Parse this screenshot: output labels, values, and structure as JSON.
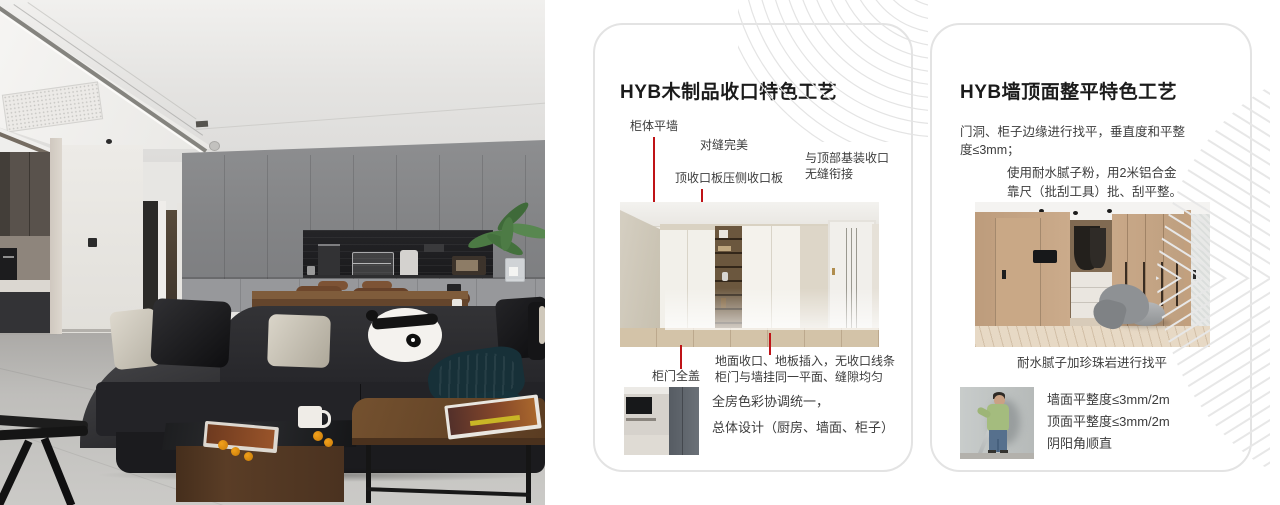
{
  "colors": {
    "accent_red": "#bf1317",
    "card_border": "#e3e3e3",
    "title_text": "#1b1b1b",
    "body_text": "#3c3c3c"
  },
  "cards": [
    {
      "title": "HYB木制品收口特色工艺",
      "callout_cabinet_wall": "柜体平墙",
      "callout_seam": "对缝完美",
      "callout_top_panel": "顶收口板压侧收口板",
      "callout_top_joint_1": "与顶部基装收口",
      "callout_top_joint_2": "无缝衔接",
      "callout_door_cover": "柜门全盖",
      "note_floor_1": "地面收口、地板插入，无收口线条",
      "note_floor_2": "柜门与墙挂同一平面、缝隙均匀",
      "note_color_1": "全房色彩协调统一，",
      "note_color_2": "总体设计（厨房、墙面、柜子）"
    },
    {
      "title": "HYB墙顶面整平特色工艺",
      "para_level_1": "门洞、柜子边缘进行找平，垂直度和平整",
      "para_level_2": "度≤3mm；",
      "para_putty_1": "使用耐水腻子粉，用2米铝合金",
      "para_putty_2": "靠尺（批刮工具）批、刮平整。",
      "caption_pearlite": "耐水腻子加珍珠岩进行找平",
      "note_wall": "墙面平整度≤3mm/2m",
      "note_ceiling": "顶面平整度≤3mm/2m",
      "note_corner": "阴阳角顺直"
    }
  ]
}
